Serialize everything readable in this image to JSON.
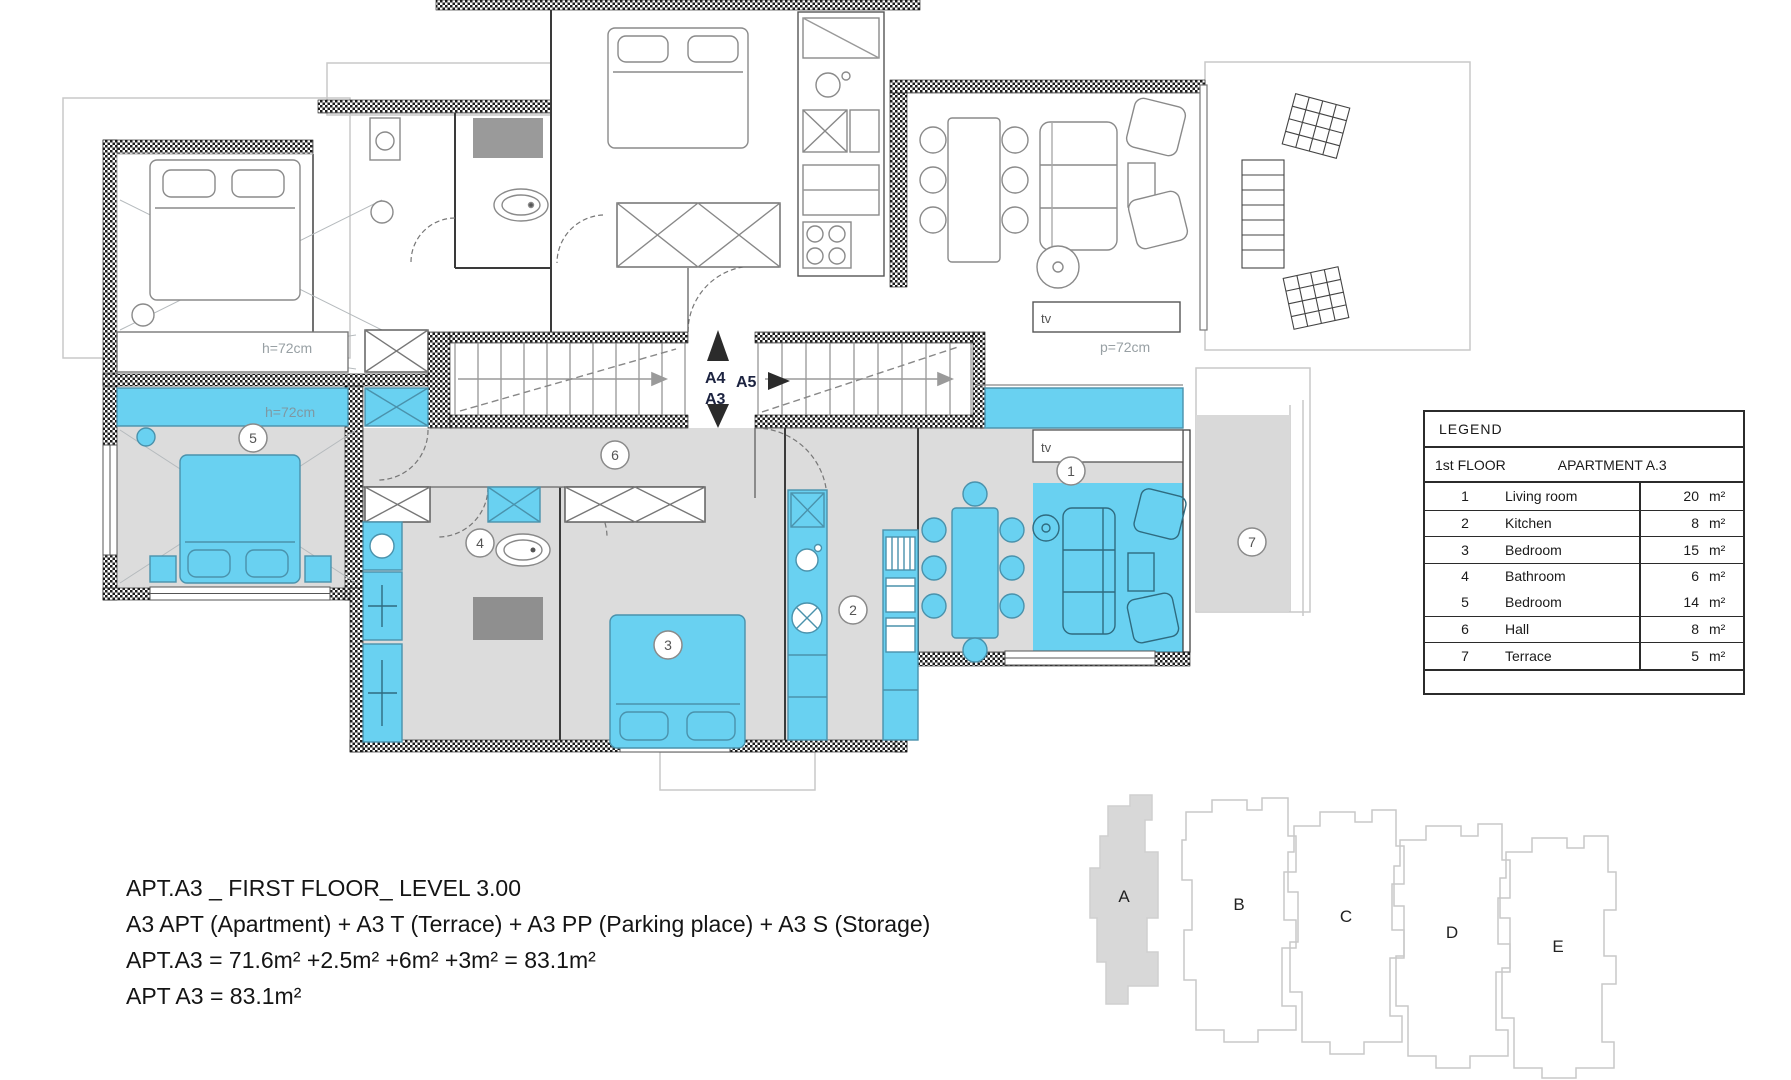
{
  "colors": {
    "highlight": "#69D1F1",
    "floor": "#DCDCDC",
    "rug": "#8F8F8F",
    "wall": "#222222"
  },
  "plan": {
    "stairs": {
      "up": "A4",
      "down": "A3",
      "entry": "A5"
    },
    "labels": {
      "shelf_upper": "h=72cm",
      "shelf_lower": "h=72cm",
      "parapet": "p=72cm",
      "tv_upper": "tv",
      "tv_lower": "tv"
    },
    "markers": [
      "1",
      "2",
      "3",
      "4",
      "5",
      "6",
      "7"
    ]
  },
  "legend": {
    "title": "LEGEND",
    "floor": "1st FLOOR",
    "apartment": "APARTMENT  A.3",
    "unit": "m²",
    "rows": [
      {
        "num": "1",
        "name": "Living room",
        "area": "20"
      },
      {
        "num": "2",
        "name": "Kitchen",
        "area": "8"
      },
      {
        "num": "3",
        "name": "Bedroom",
        "area": "15"
      },
      {
        "num": "4",
        "name": "Bathroom",
        "area": "6"
      },
      {
        "num": "5",
        "name": "Bedroom",
        "area": "14"
      },
      {
        "num": "6",
        "name": "Hall",
        "area": "8"
      },
      {
        "num": "7",
        "name": "Terrace",
        "area": "5"
      }
    ]
  },
  "summary": {
    "line1": "APT.A3 _ FIRST FLOOR_ LEVEL 3.00",
    "line2": "A3 APT (Apartment) + A3 T (Terrace) + A3 PP (Parking place) + A3 S (Storage)",
    "line3": "APT.A3 = 71.6m² +2.5m² +6m² +3m² = 83.1m²",
    "line4": "APT A3 = 83.1m²"
  },
  "keyplan": {
    "buildings": [
      "A",
      "B",
      "C",
      "D",
      "E"
    ]
  }
}
